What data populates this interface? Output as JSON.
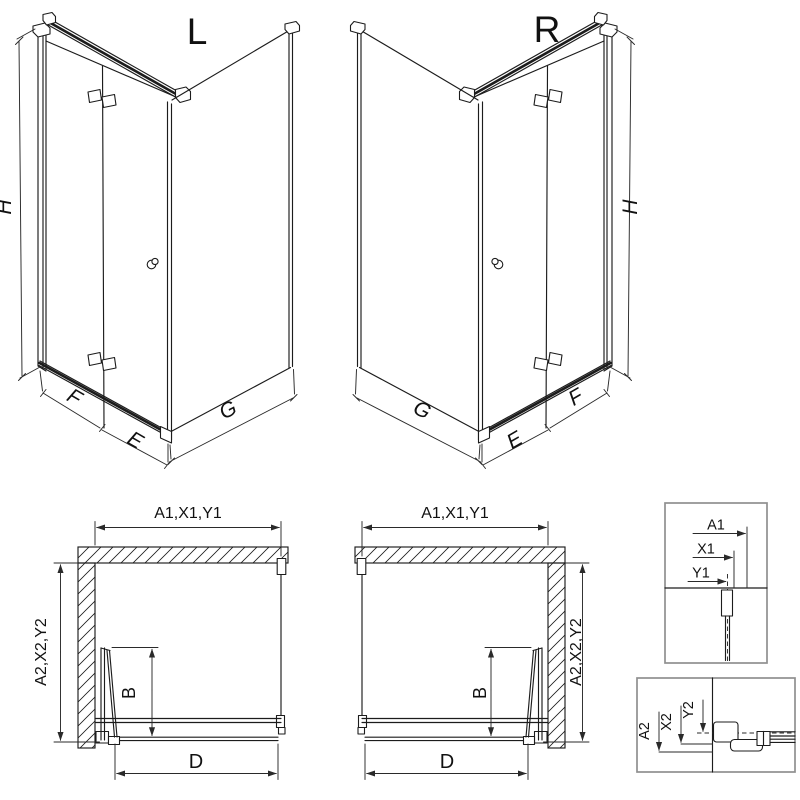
{
  "colors": {
    "background": "#ffffff",
    "line": "#1c1c1c",
    "dimension_line": "#2a2a2a",
    "detail_box_border": "#8f8f8f"
  },
  "perspective_left": {
    "label": "L",
    "dim_height": "H",
    "dim_panel_f": "F",
    "dim_panel_e": "E",
    "dim_panel_g": "G"
  },
  "perspective_right": {
    "label": "R",
    "dim_height": "H",
    "dim_panel_f": "F",
    "dim_panel_e": "E",
    "dim_panel_g": "G"
  },
  "plan_left": {
    "dim_top": "A1,X1,Y1",
    "dim_side": "A2,X2,Y2",
    "dim_fold": "B",
    "dim_entry": "D"
  },
  "plan_right": {
    "dim_top": "A1,X1,Y1",
    "dim_side": "A2,X2,Y2",
    "dim_fold": "B",
    "dim_entry": "D"
  },
  "detail_top": {
    "dim_outer": "A1",
    "dim_mid": "X1",
    "dim_axis": "Y1"
  },
  "detail_bottom": {
    "dim_outer": "A2",
    "dim_mid": "X2",
    "dim_axis": "Y2"
  }
}
